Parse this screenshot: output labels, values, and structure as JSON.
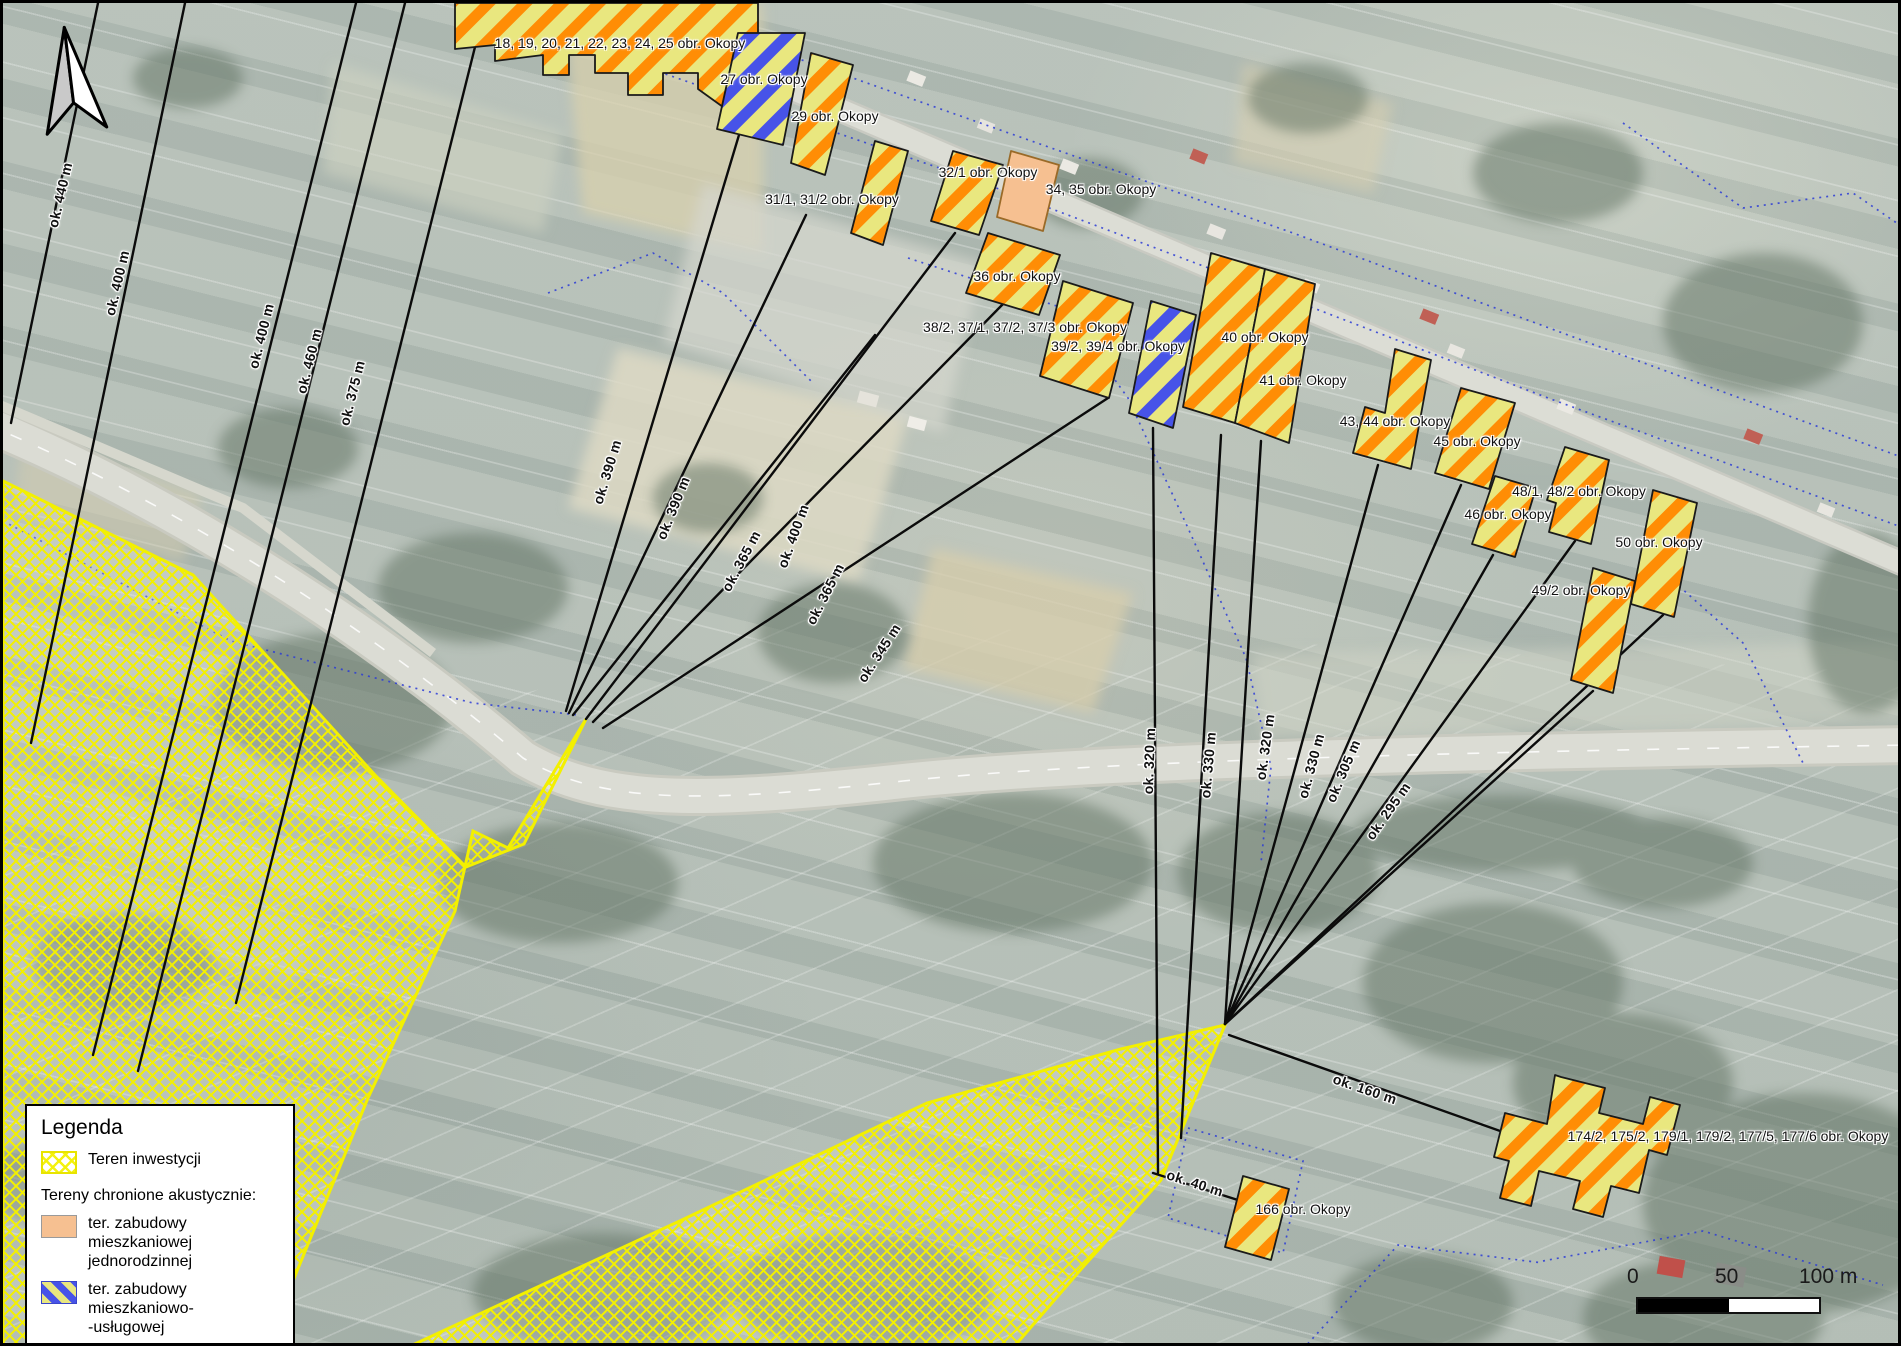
{
  "map": {
    "building_labels": [
      {
        "text": "18, 19, 20, 21, 22, 23, 24, 25 obr. Okopy",
        "x": 617,
        "y": 40
      },
      {
        "text": "27 obr. Okopy",
        "x": 761,
        "y": 76
      },
      {
        "text": "29 obr. Okopy",
        "x": 832,
        "y": 113
      },
      {
        "text": "31/1, 31/2 obr. Okopy",
        "x": 829,
        "y": 196
      },
      {
        "text": "32/1 obr. Okopy",
        "x": 985,
        "y": 169
      },
      {
        "text": "34, 35 obr. Okopy",
        "x": 1098,
        "y": 186
      },
      {
        "text": "36 obr. Okopy",
        "x": 1014,
        "y": 273
      },
      {
        "text": "38/2, 37/1, 37/2, 37/3 obr. Okopy",
        "x": 1022,
        "y": 324
      },
      {
        "text": "39/2, 39/4 obr. Okopy",
        "x": 1115,
        "y": 343
      },
      {
        "text": "40 obr. Okopy",
        "x": 1262,
        "y": 334
      },
      {
        "text": "41 obr. Okopy",
        "x": 1300,
        "y": 377
      },
      {
        "text": "43, 44 obr. Okopy",
        "x": 1392,
        "y": 418
      },
      {
        "text": "45 obr. Okopy",
        "x": 1474,
        "y": 438
      },
      {
        "text": "48/1, 48/2 obr. Okopy",
        "x": 1576,
        "y": 488
      },
      {
        "text": "46 obr. Okopy",
        "x": 1505,
        "y": 511
      },
      {
        "text": "50 obr. Okopy",
        "x": 1656,
        "y": 539
      },
      {
        "text": "49/2 obr. Okopy",
        "x": 1578,
        "y": 587
      },
      {
        "text": "174/2, 175/2, 179/1, 179/2, 177/5, 177/6 obr. Okopy",
        "x": 1725,
        "y": 1133
      },
      {
        "text": "166 obr. Okopy",
        "x": 1300,
        "y": 1206
      }
    ],
    "distance_labels": [
      {
        "text": "ok. 440 m",
        "x": 57,
        "y": 192,
        "rot": -77
      },
      {
        "text": "ok. 400 m",
        "x": 114,
        "y": 280,
        "rot": -77
      },
      {
        "text": "ok. 400 m",
        "x": 258,
        "y": 333,
        "rot": -76
      },
      {
        "text": "ok. 460 m",
        "x": 306,
        "y": 358,
        "rot": -76
      },
      {
        "text": "ok. 375 m",
        "x": 349,
        "y": 390,
        "rot": -76
      },
      {
        "text": "ok. 390 m",
        "x": 604,
        "y": 469,
        "rot": -73
      },
      {
        "text": "ok. 390 m",
        "x": 670,
        "y": 505,
        "rot": -68
      },
      {
        "text": "ok. 365 m",
        "x": 738,
        "y": 558,
        "rot": -62
      },
      {
        "text": "ok. 400 m",
        "x": 790,
        "y": 533,
        "rot": -70
      },
      {
        "text": "ok. 365 m",
        "x": 822,
        "y": 591,
        "rot": -63
      },
      {
        "text": "ok. 345 m",
        "x": 876,
        "y": 650,
        "rot": -57
      },
      {
        "text": "ok. 320 m",
        "x": 1146,
        "y": 758,
        "rot": -88
      },
      {
        "text": "ok. 330 m",
        "x": 1205,
        "y": 762,
        "rot": -85
      },
      {
        "text": "ok. 320 m",
        "x": 1262,
        "y": 744,
        "rot": -82
      },
      {
        "text": "ok. 330 m",
        "x": 1308,
        "y": 763,
        "rot": -75
      },
      {
        "text": "ok. 305 m",
        "x": 1340,
        "y": 768,
        "rot": -67
      },
      {
        "text": "ok. 295 m",
        "x": 1385,
        "y": 808,
        "rot": -55
      },
      {
        "text": "ok. 160 m",
        "x": 1362,
        "y": 1086,
        "rot": 19
      },
      {
        "text": "ok. 40 m",
        "x": 1192,
        "y": 1180,
        "rot": 18
      }
    ]
  },
  "legend": {
    "title": "Legenda",
    "item_investment": "Teren inwestycji",
    "section_protected": "Tereny chronione akustycznie:",
    "item_residential_line1": "ter. zabudowy mieszkaniowej",
    "item_residential_line2": "jednorodzinnej",
    "item_mixed_line1": "ter. zabudowy mieszkaniowo-",
    "item_mixed_line2": "-usługowej",
    "item_farm": "ter. zabudowy zagrodowej"
  },
  "scale_bar": {
    "label_0": "0",
    "label_50": "50",
    "label_100": "100 m"
  },
  "colors": {
    "investment_hatch_yellow": "#f3f000",
    "farm_stripe_orange": "#ff8d05",
    "stripe_pale_yellow": "#e9e77f",
    "mixed_stripe_blue": "#4753e8",
    "residential_orange_fill": "#f6c091",
    "measurement_line_black": "#0b0b0b",
    "cadastral_blue_dotted": "#2b3bd6"
  }
}
